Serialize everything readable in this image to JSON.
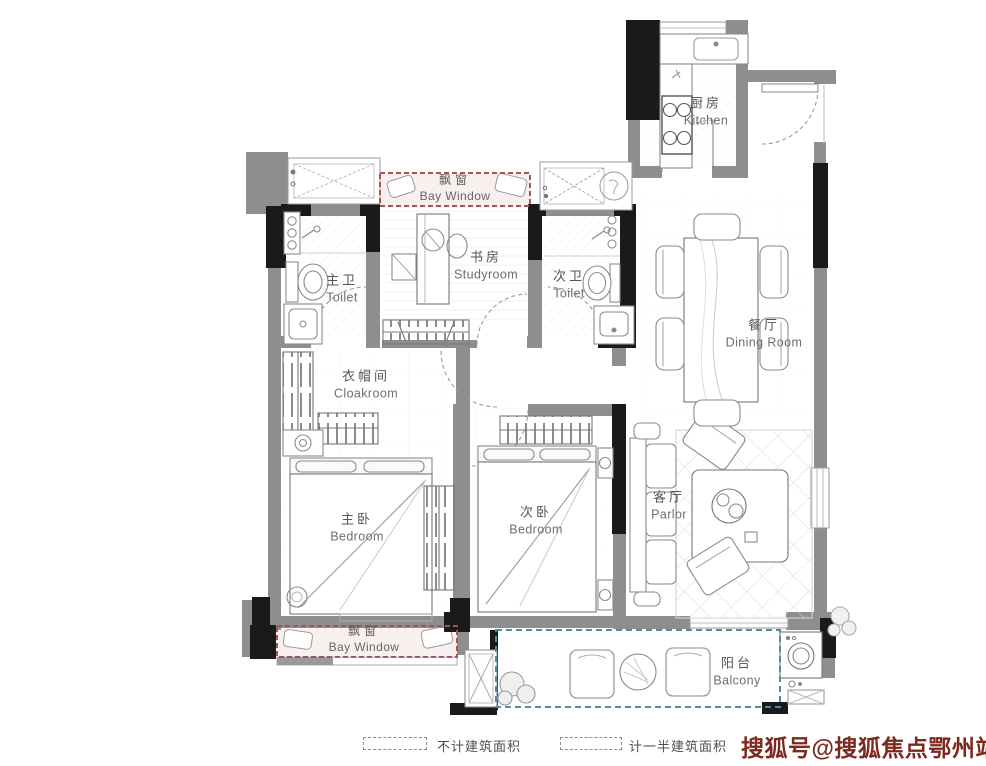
{
  "plan": {
    "rooms": [
      {
        "id": "kitchen",
        "cn": "厨房",
        "en": "Kitchen"
      },
      {
        "id": "dining-room",
        "cn": "餐厅",
        "en": "Dining Room"
      },
      {
        "id": "master-toilet",
        "cn": "主卫",
        "en": "Toilet"
      },
      {
        "id": "studyroom",
        "cn": "书房",
        "en": "Studyroom"
      },
      {
        "id": "second-toilet",
        "cn": "次卫",
        "en": "Toilet"
      },
      {
        "id": "cloakroom",
        "cn": "衣帽间",
        "en": "Cloakroom"
      },
      {
        "id": "master-bedroom",
        "cn": "主卧",
        "en": "Bedroom"
      },
      {
        "id": "second-bedroom",
        "cn": "次卧",
        "en": "Bedroom"
      },
      {
        "id": "parlor",
        "cn": "客厅",
        "en": "Parlor"
      },
      {
        "id": "balcony",
        "cn": "阳台",
        "en": "Balcony"
      },
      {
        "id": "bay-window-top",
        "cn": "飘窗",
        "en": "Bay Window"
      },
      {
        "id": "bay-window-bottom",
        "cn": "飘窗",
        "en": "Bay Window"
      }
    ],
    "legend": [
      {
        "label": "不计建筑面积",
        "swatch": "#9a8686"
      },
      {
        "label": "计一半建筑面积",
        "swatch": "#80949c"
      }
    ],
    "watermark": "搜狐号@搜狐焦点鄂州站",
    "colors": {
      "bay_window_dash": "#a85454",
      "balcony_dash": "#4e8e9c",
      "wall_gray": "#8e8e8e",
      "wall_black": "#1a1a1a",
      "watermark": "#7c2a1e"
    }
  }
}
